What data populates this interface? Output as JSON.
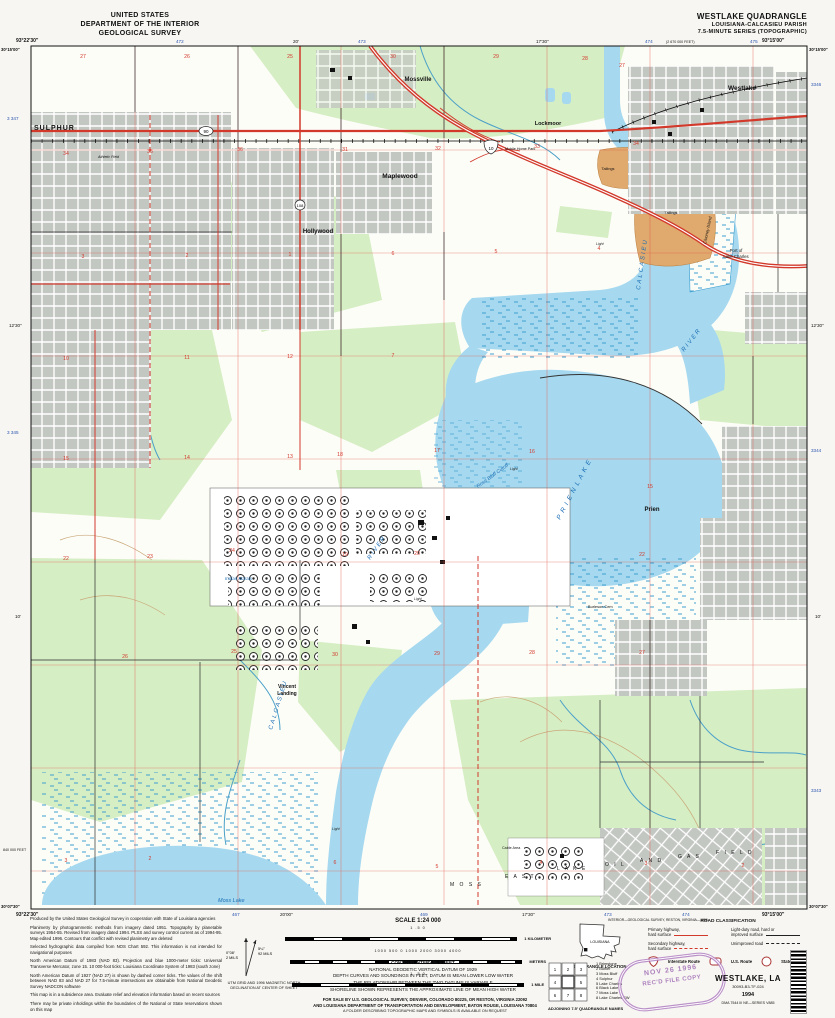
{
  "header": {
    "left1": "UNITED STATES",
    "left2": "DEPARTMENT OF THE INTERIOR",
    "left3": "GEOLOGICAL SURVEY",
    "right1": "WESTLAKE QUADRANGLE",
    "right2": "LOUISIANA-CALCASIEU PARISH",
    "right3": "7.5-MINUTE SERIES (TOPOGRAPHIC)"
  },
  "corners": {
    "tl_lon": "93°22′30″",
    "tl_lat": "30°15′00″",
    "tr_lon": "93°15′00″",
    "tr_lat": "30°15′00″",
    "bl_lon": "93°22′30″",
    "bl_lat": "30°07′30″",
    "br_lon": "93°15′00″",
    "br_lat": "30°07′30″"
  },
  "margins": {
    "top": {
      "t472": "472",
      "t20": "20′",
      "t473": "473",
      "t1730": "17′30″",
      "t474": "474",
      "tfeet": "(2 670 000 FEET)",
      "t475": "475"
    },
    "bottom": {
      "b467": "467",
      "b2000": "20′00″",
      "b469": "469",
      "b1730": "17′30″",
      "b473": "473",
      "b474": "474",
      "interior": "INTERIOR—GEOLOGICAL SURVEY, RESTON, VIRGINIA—1996"
    },
    "left": {
      "l3347": "3 347",
      "l1230": "12′30″",
      "l3345": "3 345",
      "l10": "10′",
      "lfeet": "840 000 FEET"
    },
    "right": {
      "r3346": "3346",
      "r1230": "12′30″",
      "r3344": "3344",
      "r10": "10′",
      "r3343": "3343"
    }
  },
  "map": {
    "labels": {
      "sulphur": "SULPHUR",
      "mossville": "Mossville",
      "lockmoor": "Lockmoor",
      "maplewood": "Maplewood",
      "hollywood": "Hollywood",
      "westlake": "Westlake",
      "prien": "Prien",
      "vincent1": "Vincent",
      "vincent2": "Landing",
      "moss_lake": "Moss  Lake",
      "calcasieu_n": "CALCASIEU",
      "river_n": "RIVER",
      "calcasieu_s": "CALCASIEU",
      "river_s": "RIVER",
      "prien_lake": "P R I E N   L A K E",
      "rose_bluff": "Rose  Bluff  Cutoff",
      "clooney": "Clooney Island",
      "port1": "Port of",
      "port2": "Lake Charles",
      "tailings1": "Tailings",
      "tailings2": "Tailings",
      "indian_marais": "Indian  Marais",
      "east": "E A S T",
      "moss": "M O S S",
      "lake": "L A K E",
      "oil": "O I L",
      "and": "A N D",
      "gas": "G A S",
      "field": "F I E L D",
      "burleson": "Burleson Cem",
      "cable": "Cable Area",
      "mobile": "Mobile Home Park",
      "athletic": "Athletic Field",
      "light": "Light"
    },
    "routes": {
      "us90": "90",
      "i10": "10",
      "la108": "108"
    },
    "sections": [
      "27",
      "26",
      "25",
      "30",
      "29",
      "28",
      "27",
      "34",
      "35",
      "36",
      "31",
      "32",
      "33",
      "34",
      "3",
      "2",
      "1",
      "6",
      "5",
      "4",
      "10",
      "11",
      "12",
      "7",
      "15",
      "14",
      "13",
      "18",
      "17",
      "16",
      "15",
      "22",
      "23",
      "24",
      "19",
      "20",
      "22",
      "26",
      "25",
      "30",
      "29",
      "28",
      "27",
      "3",
      "2",
      "6",
      "5",
      "4",
      "3",
      "2"
    ]
  },
  "footer": {
    "credit": {
      "p1": "Produced by the United States Geological Survey in cooperation with State of Louisiana agencies",
      "p2": "Planimetry by photogrammetric methods from imagery dated 1951. Topography by planetable surveys 1954-55. Revised from imagery dated 1994. PLSS and survey control current as of 1994-95. Map edited 1996. Contours that conflict with revised planimetry are deleted",
      "p3": "Selected hydrographic data compiled from NOS Chart 592. This information is not intended for navigational purposes",
      "p4": "North American Datum of 1983 (NAD 83). Projection and blue 1000-meter ticks: Universal Transverse Mercator, zone 15. 10 000-foot ticks: Louisiana Coordinate System of 1983 (south zone)",
      "p5": "North American Datum of 1927 (NAD 27) is shown by dashed corner ticks. The values of the shift between NAD 83 and NAD 27 for 7.5-minute intersections are obtainable from National Geodetic Survey NADCON software",
      "p6": "This map is in a subsidence area. Evaluate relief and elevation information based on recent sources",
      "p7": "There may be private inholdings within the boundaries of the National or State reservations shown on this map"
    },
    "decl": {
      "gn_deg": "0°08′",
      "gn_mils": "2 MILS",
      "mn_deg": "5¼°",
      "mn_mils": "92 MILS",
      "cap1": "UTM GRID AND 1996 MAGNETIC NORTH",
      "cap2": "DECLINATION AT CENTER OF SHEET"
    },
    "scale": {
      "title": "SCALE 1:24 000",
      "km_nums": "1        .5        0",
      "km_unit": "1 KILOMETER",
      "m_nums": "1000    500    0    1000    2000    3000    4000",
      "m_unit": "METERS",
      "mi_nums": "1        .5        0",
      "mi_unit": "1 MILE"
    },
    "contour": {
      "l1": "CONTOUR INTERVAL 5 FEET",
      "l2": "NATIONAL GEODETIC VERTICAL DATUM OF 1929",
      "l3": "DEPTH CURVES AND SOUNDINGS IN FEET, DATUM IS MEAN LOWER LOW WATER",
      "l4": "THE RELATIONSHIP BETWEEN THE TWO DATUMS IS VARIABLE",
      "l5": "SHORELINE SHOWN REPRESENTS THE APPROXIMATE LINE OF MEAN HIGH WATER"
    },
    "forsale": {
      "l1": "FOR SALE BY U.S. GEOLOGICAL SURVEY, DENVER, COLORADO 80225, OR RESTON, VIRGINIA 22092",
      "l2": "AND LOUISIANA DEPARTMENT OF TRANSPORTATION AND DEVELOPMENT, BATON ROUGE, LOUISIANA 70804",
      "l3": "A FOLDER DESCRIBING TOPOGRAPHIC MAPS AND SYMBOLS IS AVAILABLE ON REQUEST"
    },
    "roadclass": {
      "title": "ROAD CLASSIFICATION",
      "primary1": "Primary highway,",
      "primary2": "hard surface",
      "light1": "Light-duty road, hard or",
      "light2": "improved surface",
      "secondary1": "Secondary highway,",
      "secondary2": "hard surface",
      "unimproved": "Unimproved road",
      "interstate": "Interstate Route",
      "us": "U.S. Route",
      "state": "State Route"
    },
    "quadloc": {
      "state": "LOUISIANA",
      "cap": "QUADRANGLE LOCATION"
    },
    "adjoining": {
      "grid": [
        "1",
        "2",
        "3",
        "4",
        "5",
        "6",
        "7",
        "8"
      ],
      "names": [
        "1 Brimstone",
        "2 Buhler",
        "3 Moss Bluff",
        "4 Sulphur",
        "5 Lake Charles",
        "6 Black Lake",
        "7 Moss Lake",
        "8 Lake Charles SW"
      ],
      "cap": "ADJOINING 7.5′ QUADRANGLE NAMES"
    },
    "mapname": {
      "n1": "WESTLAKE, LA",
      "n2": "30093-B3-TF-024",
      "n3": "1994",
      "n4": "DMA 7544 III NE—SERIES V885"
    },
    "stamp": {
      "s1": "NOV 26 1996",
      "s2": "REC'D FILE COPY"
    }
  }
}
